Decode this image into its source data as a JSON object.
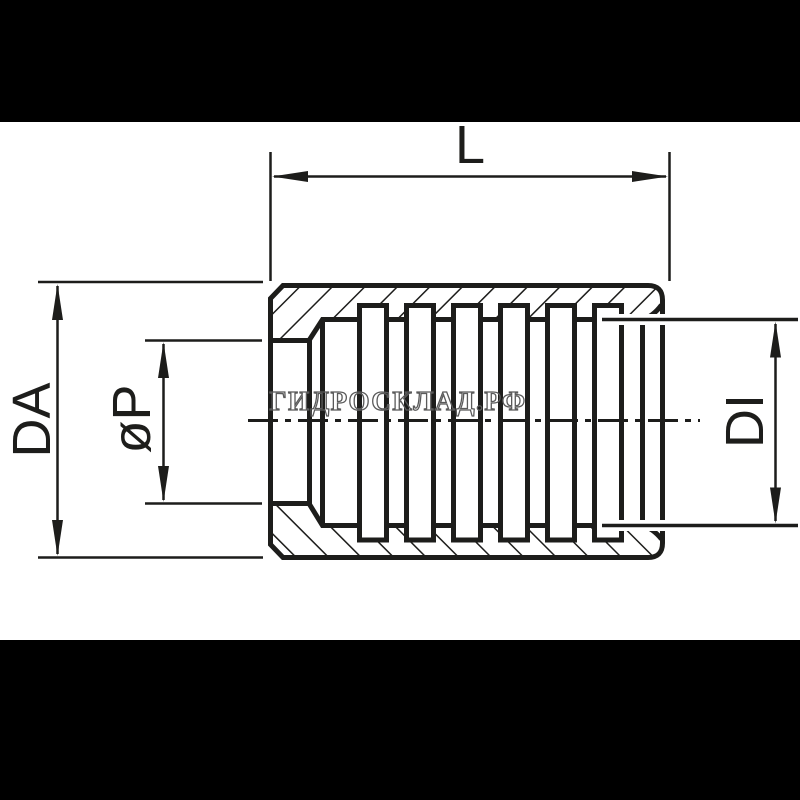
{
  "drawing": {
    "title": "Ferrule cross-section drawing",
    "labels": {
      "length": "L",
      "outer_diameter": "DA",
      "collar_bore_diameter": "øP",
      "inner_diameter": "DI"
    },
    "watermark": {
      "text": "ГИДРОСКЛАД.РФ",
      "color": "#5a5a5a"
    },
    "colors": {
      "ink": "#1d1d1b",
      "paper": "#ffffff",
      "background": "#000000",
      "halo": "#ffffff"
    },
    "serration": {
      "groove_count": 6
    }
  }
}
